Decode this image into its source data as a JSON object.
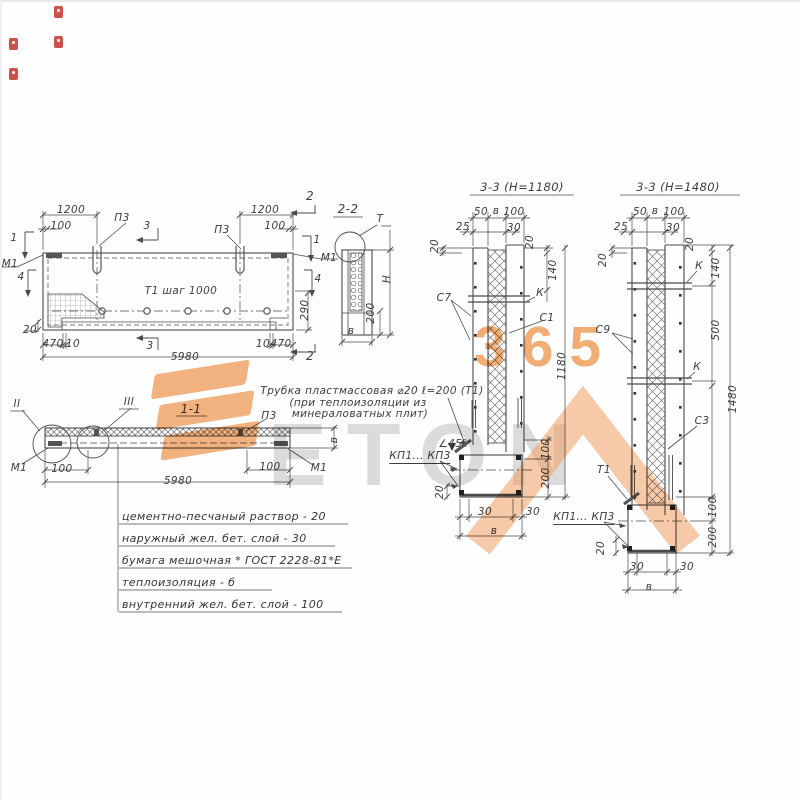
{
  "colors": {
    "ink": "#4a4a4a",
    "watermark_orange": "#f0a062",
    "watermark_gray": "#d9d9d9",
    "artifact_red": "#c6332a"
  },
  "watermark": {
    "word": "ETON",
    "digits": "365"
  },
  "views": {
    "plan": {
      "labels": [
        {
          "id": "sec1-left",
          "text": "1",
          "x": 14,
          "y": 238
        },
        {
          "id": "sec1-right",
          "text": "1",
          "x": 317,
          "y": 240
        },
        {
          "id": "sec2-top",
          "text": "2",
          "x": 310,
          "y": 196,
          "size": 12
        },
        {
          "id": "sec2-bottom",
          "text": "2",
          "x": 310,
          "y": 356,
          "size": 12
        },
        {
          "id": "sec3-top",
          "text": "3",
          "x": 147,
          "y": 226
        },
        {
          "id": "sec3-bottom",
          "text": "3",
          "x": 150,
          "y": 346
        },
        {
          "id": "sec4-left",
          "text": "4",
          "x": 21,
          "y": 277
        },
        {
          "id": "sec4-right",
          "text": "4",
          "x": 318,
          "y": 279
        },
        {
          "id": "mark-m1-left",
          "text": "М1",
          "x": 10,
          "y": 264
        },
        {
          "id": "mark-m1-right",
          "text": "М1",
          "x": 329,
          "y": 258
        },
        {
          "id": "mark-p3-left",
          "text": "П3",
          "x": 122,
          "y": 218
        },
        {
          "id": "mark-p3-right",
          "text": "П3",
          "x": 222,
          "y": 230
        },
        {
          "id": "note-t1-step",
          "text": "Т1  шаг 1000",
          "x": 181,
          "y": 291
        },
        {
          "id": "dim-1200-left",
          "text": "1200",
          "x": 71,
          "y": 210
        },
        {
          "id": "dim-100-left",
          "text": "100",
          "x": 61,
          "y": 226
        },
        {
          "id": "dim-1200-right",
          "text": "1200",
          "x": 265,
          "y": 210
        },
        {
          "id": "dim-100-right",
          "text": "100",
          "x": 275,
          "y": 226
        },
        {
          "id": "dim-20",
          "text": "20",
          "x": 30,
          "y": 330
        },
        {
          "id": "dim-470-left",
          "text": "470",
          "x": 53,
          "y": 344
        },
        {
          "id": "dim-10-left",
          "text": "10",
          "x": 73,
          "y": 344
        },
        {
          "id": "dim-10-right",
          "text": "10",
          "x": 263,
          "y": 344
        },
        {
          "id": "dim-470-right",
          "text": "470",
          "x": 281,
          "y": 344
        },
        {
          "id": "dim-5980",
          "text": "5980",
          "x": 185,
          "y": 357
        },
        {
          "id": "dim-290",
          "text": "290",
          "x": 305,
          "y": 310,
          "rot": 1
        }
      ]
    },
    "section_2_2": {
      "labels": [
        {
          "id": "title",
          "text": "2-2",
          "x": 348,
          "y": 209,
          "size": 12
        },
        {
          "id": "mark-t",
          "text": "Т",
          "x": 380,
          "y": 219
        },
        {
          "id": "dim-h",
          "text": "Н",
          "x": 387,
          "y": 279,
          "rot": 1
        },
        {
          "id": "dim-200",
          "text": "200",
          "x": 371,
          "y": 313,
          "rot": 1
        },
        {
          "id": "dim-b",
          "text": "в",
          "x": 351,
          "y": 331
        }
      ]
    },
    "section_1_1": {
      "labels": [
        {
          "id": "title",
          "text": "1-1",
          "x": 191,
          "y": 409,
          "size": 12
        },
        {
          "id": "detail-ii",
          "text": "II",
          "x": 17,
          "y": 404
        },
        {
          "id": "detail-iii",
          "text": "III",
          "x": 129,
          "y": 402
        },
        {
          "id": "mark-p3",
          "text": "П3",
          "x": 269,
          "y": 416
        },
        {
          "id": "dim-b",
          "text": "в",
          "x": 334,
          "y": 440,
          "rot": 1
        },
        {
          "id": "mark-m1-left",
          "text": "М1",
          "x": 19,
          "y": 468
        },
        {
          "id": "dim-100-left",
          "text": "100",
          "x": 62,
          "y": 469
        },
        {
          "id": "dim-100-right",
          "text": "100",
          "x": 270,
          "y": 467
        },
        {
          "id": "mark-m1-right",
          "text": "М1",
          "x": 319,
          "y": 468
        },
        {
          "id": "dim-5980",
          "text": "5980",
          "x": 178,
          "y": 481
        }
      ]
    },
    "tube_note": {
      "labels": [
        {
          "id": "line1",
          "text": "Трубка пластмассовая ⌀20 ℓ=200 (Т1)",
          "x": 372,
          "y": 391
        },
        {
          "id": "line2",
          "text": "(при теплоизоляции из",
          "x": 358,
          "y": 403
        },
        {
          "id": "line3",
          "text": "минераловатных плит)",
          "x": 360,
          "y": 414
        }
      ]
    },
    "spec_list": {
      "rows": [
        "цементно-песчаный раствор - 20",
        "наружный жел. бет. слой - 30",
        "бумага мешочная * ГОСТ 2228-81*Е",
        "теплоизоляция - б",
        "внутренний жел. бет. слой - 100"
      ]
    },
    "section_3_3_left": {
      "labels": [
        {
          "id": "title",
          "text": "3-3 (Н=1180)",
          "x": 522,
          "y": 187,
          "size": 11.5
        },
        {
          "id": "dim-50",
          "text": "50",
          "x": 481,
          "y": 212
        },
        {
          "id": "dim-b-top",
          "text": "в",
          "x": 496,
          "y": 211
        },
        {
          "id": "dim-100-top",
          "text": "100",
          "x": 514,
          "y": 212
        },
        {
          "id": "dim-25",
          "text": "25",
          "x": 463,
          "y": 227
        },
        {
          "id": "dim-30-top",
          "text": "30",
          "x": 514,
          "y": 228
        },
        {
          "id": "dim-20-left",
          "text": "20",
          "x": 435,
          "y": 246,
          "rot": 1
        },
        {
          "id": "dim-20-right",
          "text": "20",
          "x": 530,
          "y": 242,
          "rot": 1
        },
        {
          "id": "dim-140",
          "text": "140",
          "x": 553,
          "y": 270,
          "rot": 1
        },
        {
          "id": "mark-s7",
          "text": "С7",
          "x": 444,
          "y": 298
        },
        {
          "id": "mark-k",
          "text": "К",
          "x": 540,
          "y": 293
        },
        {
          "id": "mark-s1",
          "text": "С1",
          "x": 547,
          "y": 318
        },
        {
          "id": "dim-1180",
          "text": "1180",
          "x": 562,
          "y": 366,
          "rot": 1
        },
        {
          "id": "note-angle-45",
          "text": "∠45°",
          "x": 453,
          "y": 444
        },
        {
          "id": "mark-kp1-kp3",
          "text": "КП1... КП3",
          "x": 420,
          "y": 457,
          "u": 1
        },
        {
          "id": "dim-100-bot",
          "text": "100",
          "x": 546,
          "y": 449,
          "rot": 1
        },
        {
          "id": "dim-200-bot",
          "text": "200",
          "x": 546,
          "y": 478,
          "rot": 1
        },
        {
          "id": "dim-20-bot",
          "text": "20",
          "x": 440,
          "y": 492,
          "rot": 1
        },
        {
          "id": "dim-30-botL",
          "text": "30",
          "x": 485,
          "y": 512
        },
        {
          "id": "dim-30-botR",
          "text": "30",
          "x": 533,
          "y": 512
        },
        {
          "id": "dim-b-bot",
          "text": "в",
          "x": 494,
          "y": 531
        }
      ]
    },
    "section_3_3_right": {
      "labels": [
        {
          "id": "title",
          "text": "3-3  (Н=1480)",
          "x": 678,
          "y": 187,
          "size": 11.5
        },
        {
          "id": "dim-50",
          "text": "50",
          "x": 640,
          "y": 212
        },
        {
          "id": "dim-b-top",
          "text": "в",
          "x": 655,
          "y": 211
        },
        {
          "id": "dim-100-top",
          "text": "100",
          "x": 674,
          "y": 212
        },
        {
          "id": "dim-25",
          "text": "25",
          "x": 621,
          "y": 227
        },
        {
          "id": "dim-30-top",
          "text": "30",
          "x": 673,
          "y": 228
        },
        {
          "id": "dim-20-left",
          "text": "20",
          "x": 603,
          "y": 260,
          "rot": 1
        },
        {
          "id": "dim-20-right",
          "text": "20",
          "x": 690,
          "y": 244,
          "rot": 1
        },
        {
          "id": "dim-140",
          "text": "140",
          "x": 716,
          "y": 268,
          "rot": 1
        },
        {
          "id": "mark-k-top",
          "text": "К",
          "x": 699,
          "y": 266
        },
        {
          "id": "mark-s9",
          "text": "С9",
          "x": 603,
          "y": 330
        },
        {
          "id": "dim-500",
          "text": "500",
          "x": 716,
          "y": 330,
          "rot": 1
        },
        {
          "id": "mark-k-mid",
          "text": "К",
          "x": 697,
          "y": 367
        },
        {
          "id": "mark-s3",
          "text": "С3",
          "x": 702,
          "y": 421
        },
        {
          "id": "mark-t1",
          "text": "Т1",
          "x": 604,
          "y": 470
        },
        {
          "id": "dim-1480",
          "text": "1480",
          "x": 733,
          "y": 399,
          "rot": 1
        },
        {
          "id": "dim-100-bot",
          "text": "100",
          "x": 713,
          "y": 507,
          "rot": 1
        },
        {
          "id": "dim-200-bot",
          "text": "200",
          "x": 713,
          "y": 537,
          "rot": 1
        },
        {
          "id": "mark-kp1-kp3",
          "text": "КП1... КП3",
          "x": 584,
          "y": 518,
          "u": 1
        },
        {
          "id": "dim-20-bot",
          "text": "20",
          "x": 601,
          "y": 548,
          "rot": 1
        },
        {
          "id": "dim-30-botL",
          "text": "30",
          "x": 637,
          "y": 567
        },
        {
          "id": "dim-30-botR",
          "text": "30",
          "x": 687,
          "y": 567
        },
        {
          "id": "dim-b-bot",
          "text": "в",
          "x": 649,
          "y": 587
        }
      ]
    }
  }
}
